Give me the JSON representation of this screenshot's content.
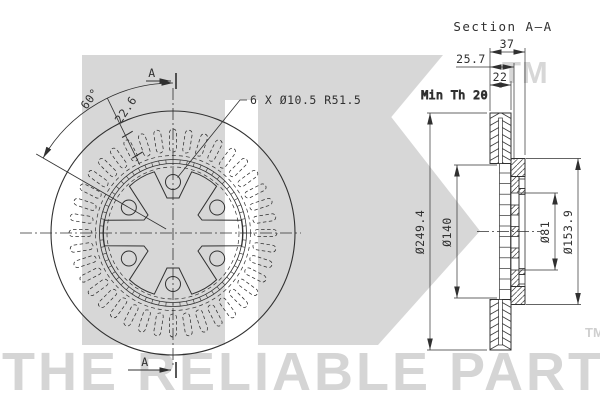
{
  "front_view": {
    "section_marker_top": "A",
    "section_marker_bottom": "A",
    "angle_dim": "60°",
    "width_dim": "22.6",
    "holes_note": "6 X Ø10.5 R51.5"
  },
  "section_view": {
    "title": "Section A–A",
    "overall_width": "37",
    "inner_width": "25.7",
    "disc_thickness": "22",
    "min_thickness": "Min Th 20",
    "outer_diameter": "Ø249.4",
    "vent_diameter": "Ø140",
    "bore_diameter": "Ø81",
    "hat_diameter": "Ø153.9"
  },
  "watermark": {
    "trademark_top": "TM",
    "tagline": "THE RELIABLE PART",
    "trademark_bottom": "TM"
  },
  "colors": {
    "line": "#303030",
    "watermark_gray": "#d7d7d7",
    "background": "#ffffff"
  }
}
